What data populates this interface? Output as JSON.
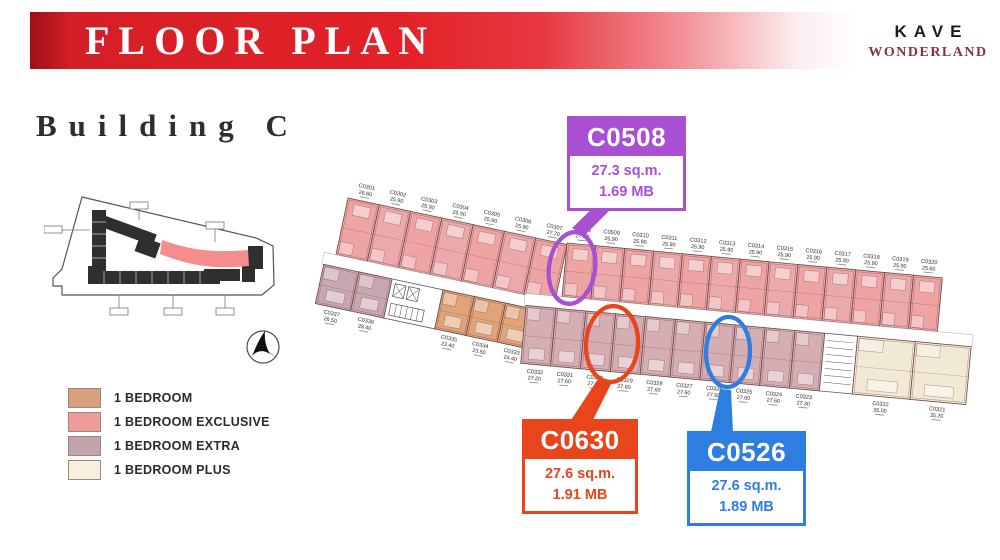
{
  "header": {
    "title": "FLOOR PLAN",
    "brand": {
      "line1": "KAVE",
      "line2": "WONDERLAND"
    }
  },
  "section": {
    "building_title": "Building C"
  },
  "legend": {
    "items": [
      {
        "label": "1 BEDROOM",
        "color": "#d8a07d"
      },
      {
        "label": "1 BEDROOM EXCLUSIVE",
        "color": "#f09c9c"
      },
      {
        "label": "1 BEDROOM EXTRA",
        "color": "#c3a4ae"
      },
      {
        "label": "1 BEDROOM PLUS",
        "color": "#f7efdd"
      }
    ]
  },
  "floor_plan": {
    "colors": {
      "exclusive": "#efa4a4",
      "exclusive_alt": "#eba9ab",
      "bedroom": "#e0a478",
      "extra_left": "#c9a7b0",
      "extra": "#d5aeb3",
      "plus": "#f2e9d4",
      "wall": "#6d4444"
    },
    "top_row_units": [
      {
        "id": "C0301",
        "area": "26.60"
      },
      {
        "id": "C0302",
        "area": "25.90"
      },
      {
        "id": "C0303",
        "area": "25.90"
      },
      {
        "id": "C0304",
        "area": "25.90"
      },
      {
        "id": "C0305",
        "area": "25.90"
      },
      {
        "id": "C0306",
        "area": "25.90"
      },
      {
        "id": "C0307",
        "area": "27.70"
      },
      {
        "id": "C0508",
        "area": "27.30"
      },
      {
        "id": "C0509",
        "area": "25.90"
      },
      {
        "id": "C0310",
        "area": "25.90"
      },
      {
        "id": "C0311",
        "area": "25.90"
      },
      {
        "id": "C0312",
        "area": "25.90"
      },
      {
        "id": "C0313",
        "area": "25.90"
      },
      {
        "id": "C0314",
        "area": "25.90"
      },
      {
        "id": "C0315",
        "area": "25.90"
      },
      {
        "id": "C0316",
        "area": "25.90"
      },
      {
        "id": "C0317",
        "area": "25.90"
      },
      {
        "id": "C0318",
        "area": "25.90"
      },
      {
        "id": "C0319",
        "area": "25.90"
      },
      {
        "id": "C0320",
        "area": "25.60"
      }
    ],
    "bottom_row_left_units": [
      {
        "id": "C0337",
        "area": "26.50"
      },
      {
        "id": "C0336",
        "area": "28.40"
      }
    ],
    "bottom_row_bedroom_units": [
      {
        "id": "C0335",
        "area": "23.40"
      },
      {
        "id": "C0334",
        "area": "23.50"
      },
      {
        "id": "C0333",
        "area": "24.40"
      }
    ],
    "bottom_row_extra_units": [
      {
        "id": "C0332",
        "area": "27.20"
      },
      {
        "id": "C0331",
        "area": "27.60"
      },
      {
        "id": "C0330",
        "area": "27.60"
      },
      {
        "id": "C0329",
        "area": "27.60"
      },
      {
        "id": "C0328",
        "area": "27.60"
      },
      {
        "id": "C0327",
        "area": "27.60"
      },
      {
        "id": "C0326",
        "area": "27.60"
      },
      {
        "id": "C0325",
        "area": "27.60"
      },
      {
        "id": "C0324",
        "area": "27.60"
      },
      {
        "id": "C0323",
        "area": "27.30"
      }
    ],
    "bottom_row_plus_units": [
      {
        "id": "C0322",
        "area": "35.00"
      },
      {
        "id": "C0321",
        "area": "35.70"
      }
    ],
    "highlighted_units": [
      "C0508",
      "C0330",
      "C0326"
    ]
  },
  "callouts": [
    {
      "id": "C0508",
      "area": "27.3 sq.m.",
      "price": "1.69 MB",
      "color": "#a94fd2"
    },
    {
      "id": "C0630",
      "area": "27.6 sq.m.",
      "price": "1.91 MB",
      "color": "#e8451c"
    },
    {
      "id": "C0526",
      "area": "27.6 sq.m.",
      "price": "1.89 MB",
      "color": "#2e7de0"
    }
  ]
}
